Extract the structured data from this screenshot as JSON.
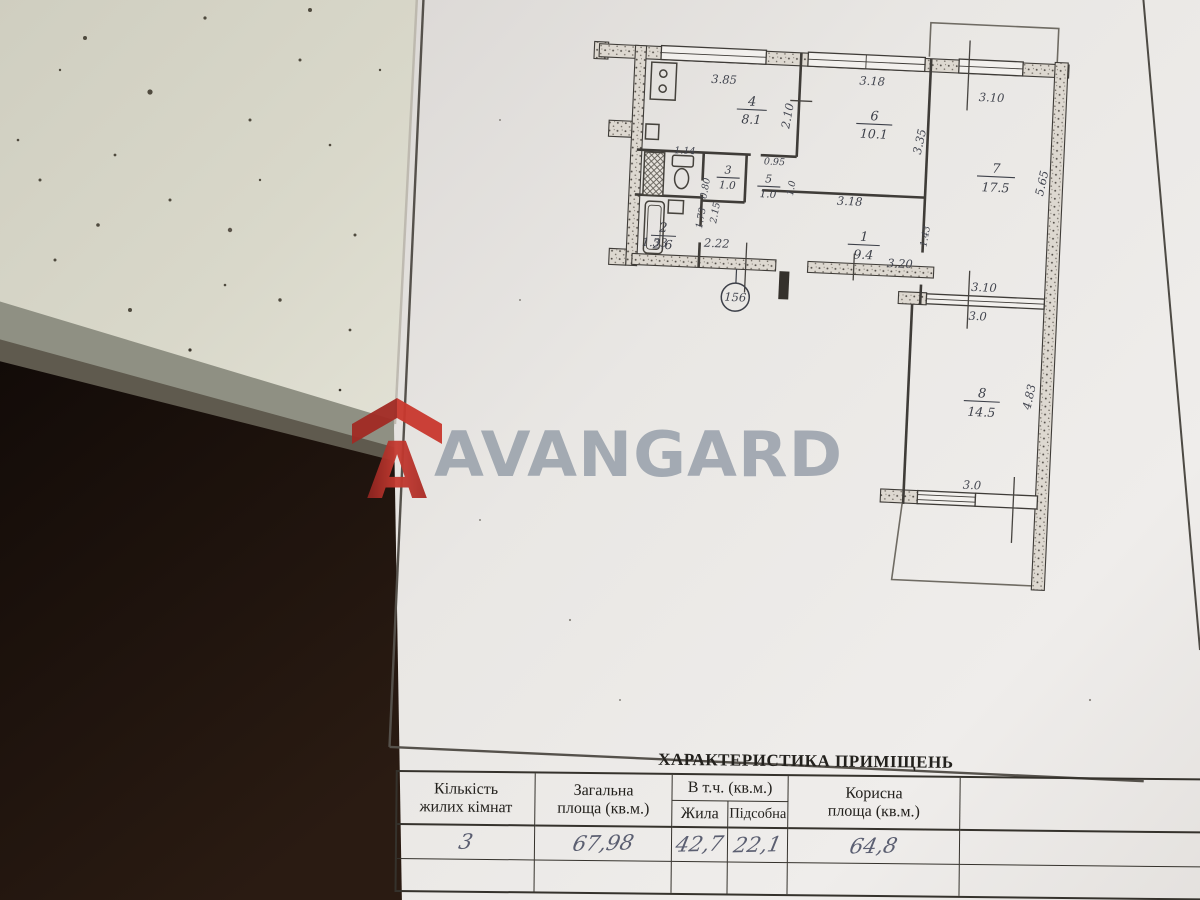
{
  "watermark": {
    "brand": "AVANGARD"
  },
  "plan": {
    "unit_number": "156",
    "rooms": {
      "kitchen": {
        "num": "4",
        "area": "8.1"
      },
      "room6": {
        "num": "6",
        "area": "10.1"
      },
      "room7": {
        "num": "7",
        "area": "17.5"
      },
      "room8": {
        "num": "8",
        "area": "14.5"
      },
      "hall": {
        "num": "1",
        "area": "9.4"
      },
      "wc": {
        "num": "3",
        "area": "1.0"
      },
      "pantry": {
        "num": "5",
        "area": "1.0"
      },
      "bath": {
        "num": "2",
        "area": "2.6"
      }
    },
    "dims": {
      "top_kitchen": "3.85",
      "top_room6": "3.18",
      "top_room7": "3.10",
      "kitchen_depth": "2.10",
      "wc_top": "1.14",
      "pantry_top": "0.95",
      "pantry_side": "1.0",
      "wc_side": "0.80",
      "bath_side1": "1.73",
      "bath_side2": "2.15",
      "bath_bottom": "1.33",
      "hall_left": "2.22",
      "hall_mid": "3.18",
      "hall_right_side": "1.43",
      "hall_bottom": "3.20",
      "room6_side": "3.35",
      "room7_side": "5.65",
      "divider_top": "3.10",
      "divider_bottom": "3.0",
      "room8_side": "4.83",
      "room8_bottom": "3.0"
    }
  },
  "table": {
    "title": "ХАРАКТЕРИСТИКА ПРИМІЩЕНЬ",
    "columns": {
      "rooms_line1": "Кількість",
      "rooms_line2": "жилих кімнат",
      "total_line1": "Загальна",
      "total_line2": "площа (кв.м.)",
      "incl": "В т.ч. (кв.м.)",
      "living": "Жила",
      "utility": "Підсобна",
      "useful_line1": "Корисна",
      "useful_line2": "площа (кв.м.)"
    },
    "values": {
      "rooms": "3",
      "total": "67,98",
      "living": "42,7",
      "utility": "22,1",
      "useful": "64,8"
    }
  }
}
